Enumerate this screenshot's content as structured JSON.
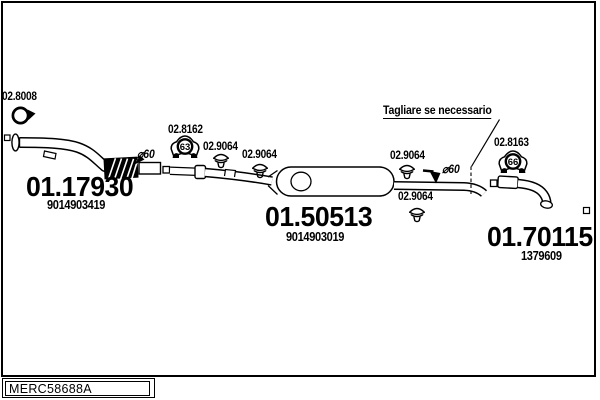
{
  "note": {
    "text": "Tagliare se necessario"
  },
  "dimensions": {
    "left": "⌀60",
    "right": "⌀60"
  },
  "parts": {
    "front_pipe": {
      "code": "01.17930",
      "ref": "9014903419"
    },
    "center_muffler": {
      "code": "01.50513",
      "ref": "9014903019"
    },
    "rear_tailpipe": {
      "code": "01.70115",
      "ref": "1379609"
    },
    "ring_clamp": {
      "code": "02.8008"
    },
    "mount_front": {
      "code": "02.8162",
      "size": "63"
    },
    "mount_rear": {
      "code": "02.8163",
      "size": "66"
    },
    "clamps": [
      {
        "code": "02.9064"
      },
      {
        "code": "02.9064"
      },
      {
        "code": "02.9064"
      },
      {
        "code": "02.9064"
      }
    ]
  },
  "footer": {
    "drawing_code": "MERC58688A"
  },
  "colors": {
    "line": "#000000",
    "background": "#ffffff"
  }
}
